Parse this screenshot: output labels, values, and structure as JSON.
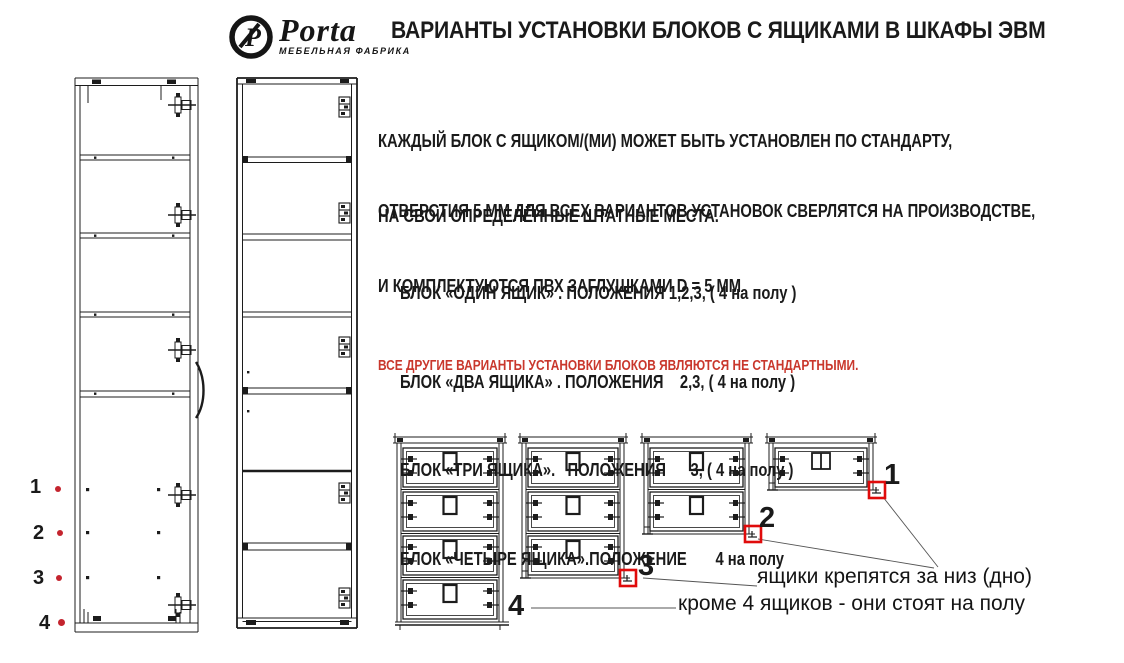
{
  "logo": {
    "brand": "Porta",
    "subtitle": "МЕБЕЛЬНАЯ ФАБРИКА",
    "emblem_letter": "P"
  },
  "title": "ВАРИАНТЫ УСТАНОВКИ БЛОКОВ С ЯЩИКАМИ В ШКАФЫ ЭВМ",
  "paragraphs": {
    "p1_line1": "КАЖДЫЙ БЛОК С ЯЩИКОМ/(МИ) МОЖЕТ БЫТЬ УСТАНОВЛЕН ПО СТАНДАРТУ,",
    "p1_line2": "НА СВОИ ОПРЕДЕЛЁННЫЕ ШТАТНЫЕ МЕСТА.",
    "p2_line1": "ОТВЕРСТИЯ 5 ММ ДЛЯ ВСЕХ ВАРИАНТОВ УСТАНОВОК СВЕРЛЯТСЯ НА ПРОИЗВОДСТВЕ,",
    "p2_line2": "И КОМПЛЕКТУЮТСЯ ПВХ ЗАГЛУШКАМИ D = 5 ММ"
  },
  "block_list": [
    "БЛОК «ОДИН ЯЩИК» . ПОЛОЖЕНИЯ 1,2,3, ( 4 на полу )",
    "БЛОК «ДВА ЯЩИКА» . ПОЛОЖЕНИЯ    2,3, ( 4 на полу )",
    "БЛОК «ТРИ ЯЩИКА».   ПОЛОЖЕНИЯ      3, ( 4 на полу )",
    "БЛОК «ЧЕТЫРЕ ЯЩИКА».ПОЛОЖЕНИЕ       4 на полу"
  ],
  "warning": "ВСЕ ДРУГИЕ ВАРИАНТЫ УСТАНОВКИ БЛОКОВ ЯВЛЯЮТСЯ НЕ СТАНДАРТНЫМИ.",
  "position_markers": [
    {
      "label": "1"
    },
    {
      "label": "2"
    },
    {
      "label": "3"
    },
    {
      "label": "4"
    }
  ],
  "drawer_blocks": [
    {
      "label": "4",
      "drawers": 4,
      "red_square": false
    },
    {
      "label": "3",
      "drawers": 3,
      "red_square": true
    },
    {
      "label": "2",
      "drawers": 2,
      "red_square": true
    },
    {
      "label": "1",
      "drawers": 1,
      "red_square": true
    }
  ],
  "note": {
    "line1": "ящики крепятся за низ (дно)",
    "line2": "кроме 4 ящиков - они стоят на полу"
  },
  "colors": {
    "ink": "#1a1a1a",
    "warning_red": "#c9372c",
    "marker_red": "#c4242e",
    "square_red": "#e00b0b"
  }
}
